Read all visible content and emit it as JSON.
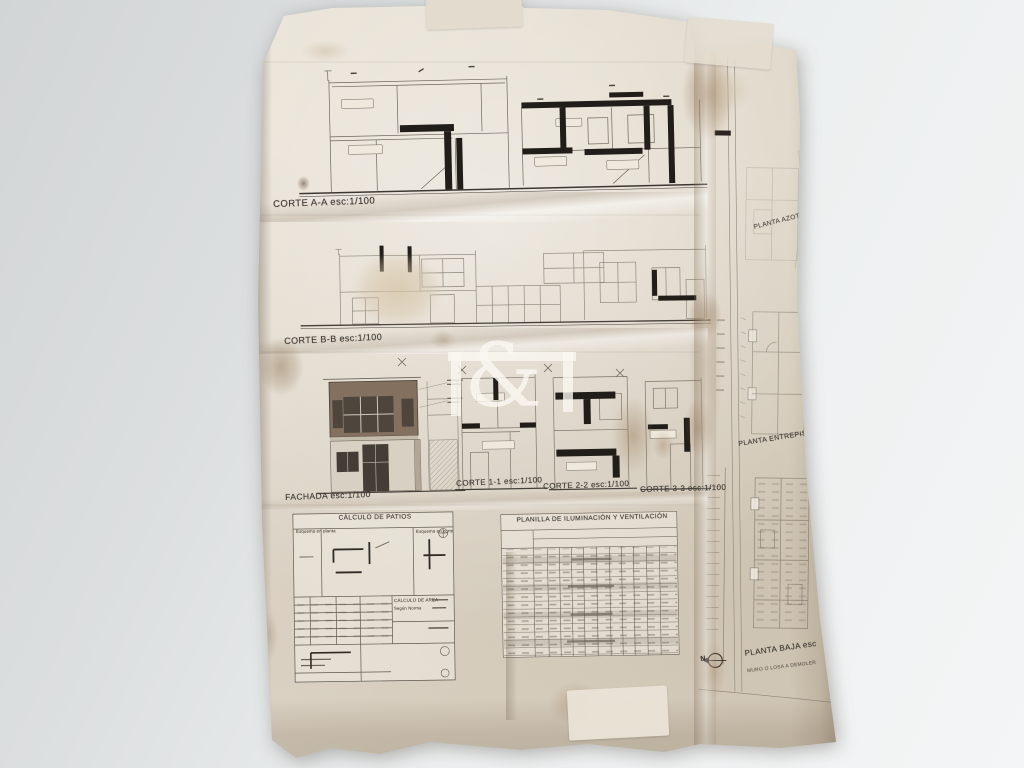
{
  "scene": {
    "description": "Photograph of a folded, stained architectural blueprint sheet on a grey surface",
    "paper_color": "#e6dfd2",
    "background_color": "#e4e7e8",
    "ink_color": "#6e665b",
    "slab_color": "#211d19",
    "facade_color": "#84705f",
    "stain_color": "#8a6f4e"
  },
  "labels": {
    "corte_aa": "CORTE A-A esc:1/100",
    "corte_bb": "CORTE B-B esc:1/100",
    "fachada": "FACHADA esc:1/100",
    "corte_11": "CORTE 1-1 esc:1/100",
    "corte_22": "CORTE 2-2 esc:1/100",
    "corte_33": "CORTE 3-3 esc:1/100",
    "planta_azotea": "PLANTA AZOTEA",
    "planta_entrepiso": "PLANTA ENTREPISO",
    "planta_baja": "PLANTA BAJA esc",
    "nota_muro": "MURO O LOSA A DEMOLER",
    "north": "N"
  },
  "tables": {
    "calculo_patios": {
      "title": "CÁLCULO DE PATIOS",
      "esquema_planta": "Esquema en planta",
      "esquema_corte": "Esquema en corte",
      "calculo_area": "CÁLCULO DE AREA",
      "segun_norma": "Según Norma"
    },
    "planilla": {
      "title": "PLANILLA DE ILUMINACIÓN Y VENTILACIÓN"
    }
  },
  "watermark": {
    "text": "F&F",
    "amp": "&"
  },
  "drawings": {
    "corte_aa": "section-drawing-A-A",
    "corte_bb": "section-drawing-B-B",
    "fachada": "front-elevation-drawing",
    "corte_11": "section-drawing-1-1",
    "corte_22": "section-drawing-2-2",
    "corte_33": "section-drawing-3-3",
    "planta_azotea": "roof-plan",
    "planta_entrepiso": "mezzanine-plan",
    "planta_baja": "ground-floor-plan"
  }
}
